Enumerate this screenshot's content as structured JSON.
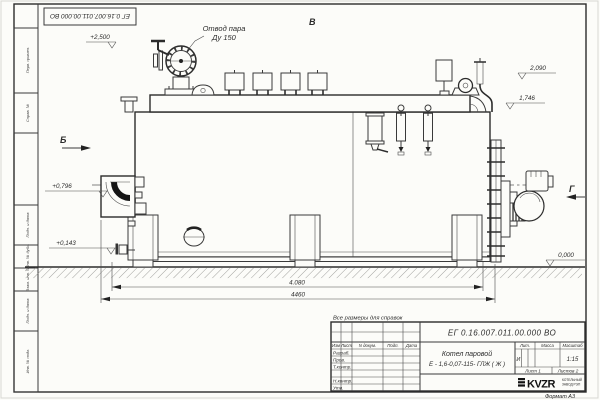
{
  "sheet": {
    "stamp_number_top": "ЕГ 0.16.007.011.00.000 ВО",
    "note": "Все размеры для справок",
    "format": "Формат А3"
  },
  "callouts": {
    "steam_line1": "Отвод пара",
    "steam_line2": "Ду 150"
  },
  "views": {
    "b": "Б",
    "v": "В",
    "g": "Г"
  },
  "elevations": {
    "e2500": "+2,500",
    "e2090": "2,090",
    "e1746": "1,746",
    "e0796": "+0,796",
    "e0143": "+0,143",
    "e0000": "0,000"
  },
  "dimensions": {
    "d4080": "4.080",
    "d4460": "4460"
  },
  "title_block": {
    "number": "ЕГ 0.16.007.011.00.000 ВО",
    "name1": "Котел паровой",
    "name2": "Е - 1,6-0,07-115- ГЛЖ ( Ж )",
    "hdr": {
      "izm": "Изм",
      "list": "Лист",
      "doc": "N докум.",
      "podp": "Подп.",
      "data": "Дата"
    },
    "rows": [
      "Разраб.",
      "Пров.",
      "Т.контр.",
      "",
      "Н.контр.",
      "Утв."
    ],
    "lit": "Лит.",
    "mass": "Масса",
    "scale": "Масштаб",
    "lit_val": "И",
    "scale_val": "1:15",
    "sheet": "Лист 1",
    "sheets": "Листов 2",
    "logo": "KVZR",
    "logo_sub1": "КОТЕЛЬНЫЙ",
    "logo_sub2": "ЗАВОД РЭП"
  },
  "side_stamps": [
    "Перв. примен.",
    "Справ. №",
    "Подп. и дата",
    "Инв. № дубл.",
    "Взам. инв. №",
    "Подп. и дата",
    "Инв. № подл."
  ]
}
